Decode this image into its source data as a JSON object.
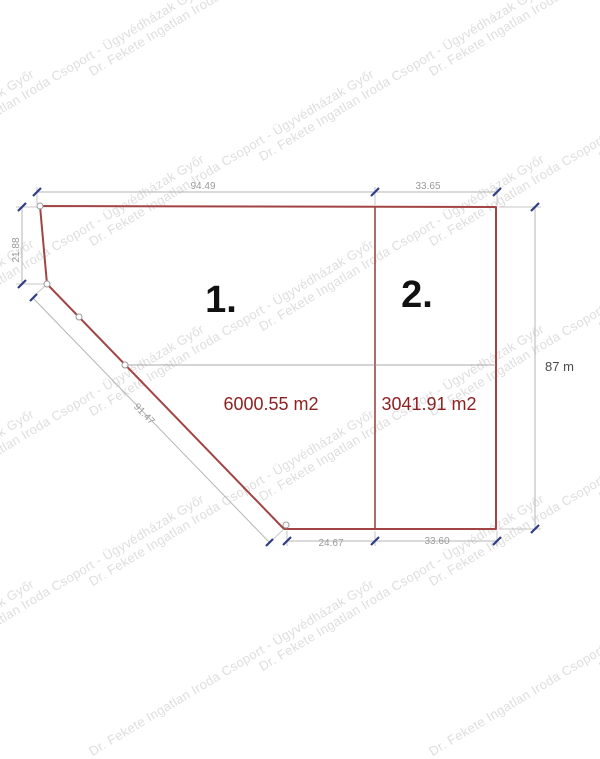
{
  "watermark": {
    "text": "Dr. Fekete Ingatlan Iroda Csoport - Ügyvédházak Győr"
  },
  "drawing": {
    "parcels": [
      {
        "number": "1.",
        "area": "6000.55 m2"
      },
      {
        "number": "2.",
        "area": "3041.91 m2"
      }
    ],
    "dimensions": {
      "top_left": "94.49",
      "top_right": "33.65",
      "left_side": "21.88",
      "diagonal": "91.47",
      "bottom_left": "24.67",
      "bottom_right": "33.60",
      "right_side": "87 m"
    },
    "colors": {
      "plot_outline": "#a24444",
      "area_text": "#8e2222",
      "parcel_number": "#111111",
      "dimension_line": "#b5b5b5",
      "dimension_text": "#9b9b9b",
      "dimension_text_dark": "#4a4a4a",
      "tick": "#2e3e86",
      "inner_line": "#8f8f8f",
      "watermark": "#dedede"
    }
  }
}
